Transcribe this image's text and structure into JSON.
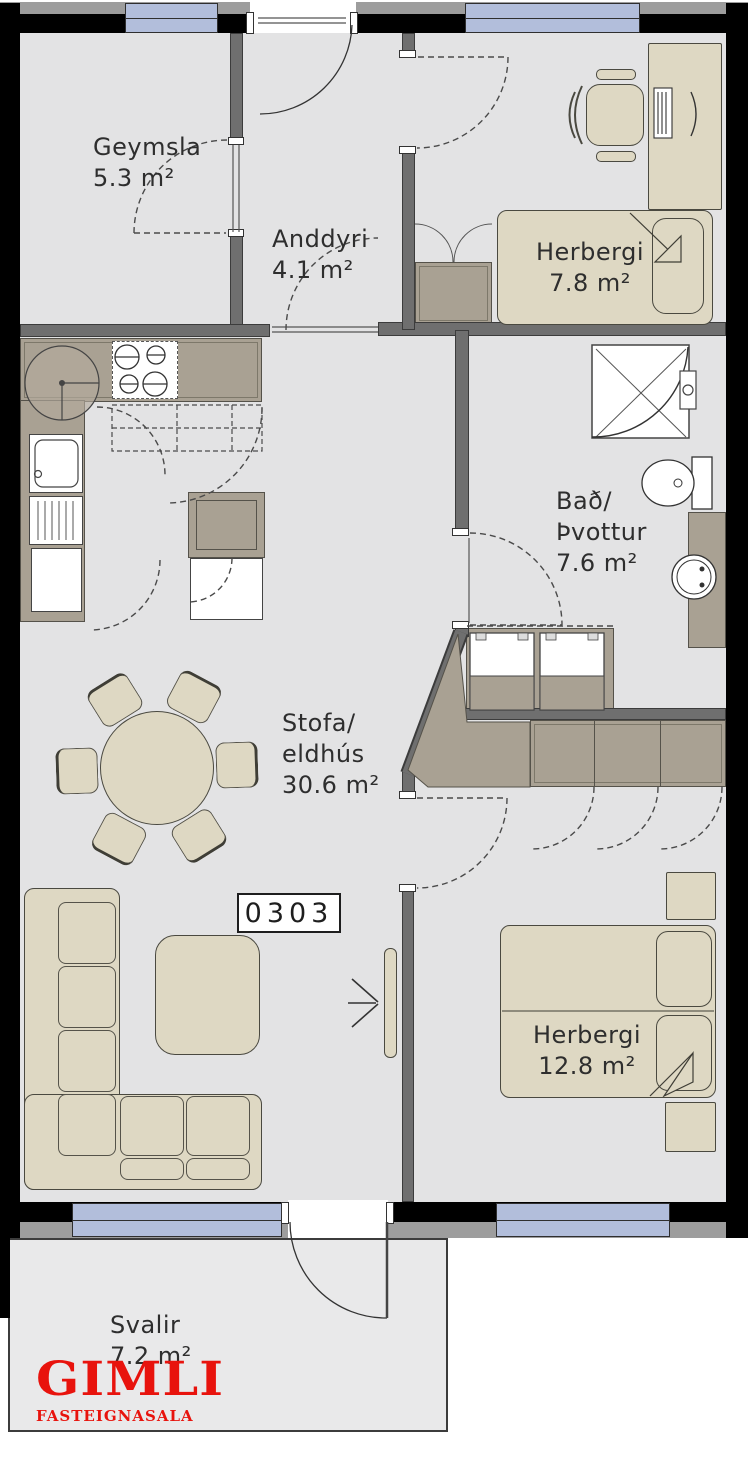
{
  "meta": {
    "unit_number": "0303"
  },
  "rooms": {
    "geymsla": {
      "lines": [
        "Geymsla",
        "5.3 m²"
      ]
    },
    "anddyri": {
      "lines": [
        "Anddyri",
        "4.1 m²"
      ]
    },
    "herbergi_small": {
      "lines": [
        "Herbergi",
        "7.8 m²"
      ]
    },
    "bad_thvottur": {
      "lines": [
        "Bað/",
        "Þvottur",
        "7.6 m²"
      ]
    },
    "stofa_eldhus": {
      "lines": [
        "Stofa/",
        "eldhús",
        "30.6 m²"
      ]
    },
    "herbergi_large": {
      "lines": [
        "Herbergi",
        "12.8 m²"
      ]
    },
    "svalir": {
      "lines": [
        "Svalir",
        "7.2 m²"
      ]
    }
  },
  "logo": {
    "name": "GIMLI",
    "subtitle": "FASTEIGNASALA",
    "color": "#e8130d"
  },
  "colors": {
    "outer_wall": "#000000",
    "partition_wall": "#6f6f6f",
    "window": "#b2bedb",
    "floor": "#e3e3e4",
    "cabinet": "#a9a193",
    "furniture": "#ded8c3",
    "logo_red": "#e8130d",
    "line": "#3d3d3d"
  },
  "icons": [
    "entrance-arrow",
    "door-swing-arc",
    "shower",
    "toilet",
    "washbasin",
    "stove-burners",
    "kitchen-sink",
    "corner-carousel",
    "fridge-freezer",
    "washer",
    "dryer",
    "single-bed",
    "double-bed",
    "pillow",
    "desk",
    "office-chair",
    "dining-table",
    "dining-chair",
    "corner-sofa",
    "coffee-table",
    "wardrobe",
    "nightstand",
    "radiator-door-leaf"
  ]
}
